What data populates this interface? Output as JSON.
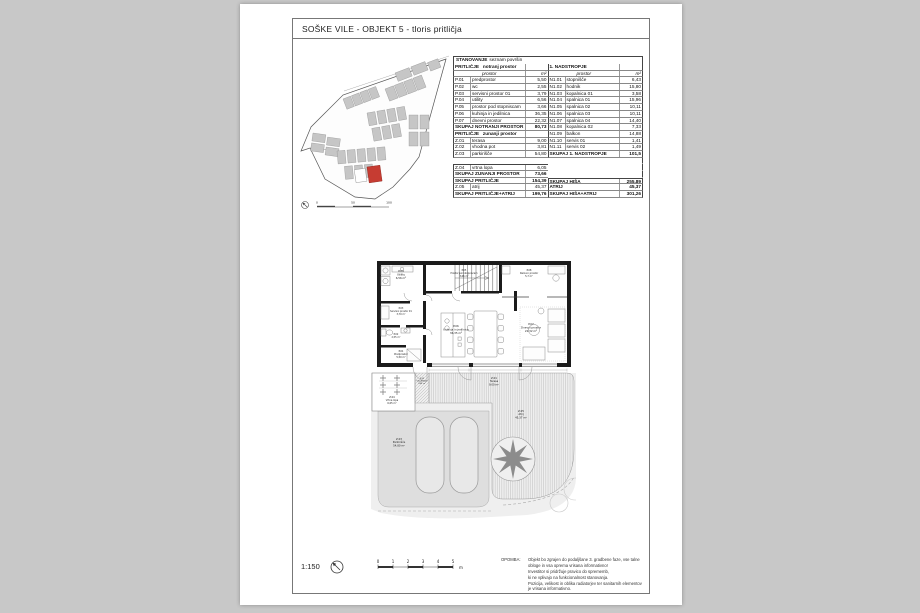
{
  "page": {
    "title": "SOŠKE VILE - OBJEKT 5 - tloris pritličja"
  },
  "table": {
    "title_main": "STANOVANJE",
    "title_sub": "seznam površin",
    "rows": [
      {
        "l": {
          "t": "sub",
          "n": "PRITLIČJE",
          "n2": "notranj prostor"
        },
        "r": {
          "t": "sub",
          "n": "1. NADSTROPJE"
        }
      },
      {
        "l": {
          "t": "col",
          "n": "prostor",
          "v": "m²"
        },
        "r": {
          "t": "col",
          "n": "prostor",
          "v": "m²"
        }
      },
      {
        "l": {
          "t": "data",
          "c": "P.01",
          "n": "predprostor",
          "v": "5,50"
        },
        "r": {
          "t": "data",
          "c": "N1.01",
          "n": "stopnišče",
          "v": "6,43"
        }
      },
      {
        "l": {
          "t": "data",
          "c": "P.02",
          "n": "wc",
          "v": "2,55"
        },
        "r": {
          "t": "data",
          "c": "N1.02",
          "n": "hodnik",
          "v": "15,80"
        }
      },
      {
        "l": {
          "t": "data",
          "c": "P.03",
          "n": "servisni prostor 01",
          "v": "3,79"
        },
        "r": {
          "t": "data",
          "c": "N1.03",
          "n": "kopalnica 01",
          "v": "3,58"
        }
      },
      {
        "l": {
          "t": "data",
          "c": "P.04",
          "n": "utility",
          "v": "6,56"
        },
        "r": {
          "t": "data",
          "c": "N1.04",
          "n": "spalnica 01",
          "v": "15,96"
        }
      },
      {
        "l": {
          "t": "data",
          "c": "P.05",
          "n": "prostor pod stopniscam",
          "v": "3,66"
        },
        "r": {
          "t": "data",
          "c": "N1.05",
          "n": "spalnica 02",
          "v": "10,11"
        }
      },
      {
        "l": {
          "t": "data",
          "c": "P.06",
          "n": "kuhinja in jedilnica",
          "v": "36,35"
        },
        "r": {
          "t": "data",
          "c": "N1.06",
          "n": "spalnica 03",
          "v": "10,11"
        }
      },
      {
        "l": {
          "t": "data",
          "c": "P.07",
          "n": "dnevni prostor",
          "v": "22,32"
        },
        "r": {
          "t": "data",
          "c": "N1.07",
          "n": "spalnica 04",
          "v": "14,40"
        }
      },
      {
        "l": {
          "t": "total",
          "n": "SKUPAJ NOTRANJI PROSTOR",
          "v": "80,73"
        },
        "r": {
          "t": "data",
          "c": "N1.08",
          "n": "kopalnica 02",
          "v": "7,33"
        }
      },
      {
        "l": {
          "t": "sub",
          "n": "PRITLIČJE",
          "n2": "zunanji prostor"
        },
        "r": {
          "t": "data",
          "c": "N1.09",
          "n": "balkon",
          "v": "14,88"
        }
      },
      {
        "l": {
          "t": "data",
          "c": "Z.01",
          "n": "terasa",
          "v": "9,00"
        },
        "r": {
          "t": "data",
          "c": "N1.10",
          "n": "servis 01",
          "v": "1,41"
        }
      },
      {
        "l": {
          "t": "data",
          "c": "Z.02",
          "n": "vhodna pot",
          "v": "3,81"
        },
        "r": {
          "t": "data",
          "c": "N1.11",
          "n": "servis 02",
          "v": "1,49"
        }
      },
      {
        "l": {
          "t": "data",
          "c": "Z.03",
          "n": "parkirišče",
          "v": "54,80"
        },
        "r": {
          "t": "total",
          "n": "SKUPAJ 1. NADSTROPJE",
          "v": "101,5"
        }
      },
      {
        "l": {
          "t": "blank"
        },
        "r": {
          "t": "blank"
        }
      },
      {
        "l": {
          "t": "data",
          "c": "Z.04",
          "n": "vrtna lopa",
          "v": "6,05",
          "bt": true
        },
        "r": {
          "t": "blank"
        }
      },
      {
        "l": {
          "t": "total",
          "n": "SKUPAJ ZUNANJI PROSTOR",
          "v": "73,66"
        },
        "r": {
          "t": "blank"
        }
      },
      {
        "l": {
          "t": "total",
          "n": "SKUPAJ PRITLIČJE",
          "v": "154,39"
        },
        "r": {
          "t": "total",
          "n": "SKUPAJ HIŠA",
          "v": "255,89",
          "bt": true
        }
      },
      {
        "l": {
          "t": "data",
          "c": "Z.05",
          "n": "atrij",
          "v": "45,37"
        },
        "r": {
          "t": "total",
          "n": "ATRIJ",
          "v": "45,37"
        }
      },
      {
        "l": {
          "t": "total",
          "n": "SKUPAJ PRITLIČJE+ATRIJ",
          "v": "199,76"
        },
        "r": {
          "t": "total",
          "n": "SKUPAJ HIŠA+ATRIJ",
          "v": "301,26"
        }
      }
    ]
  },
  "plan": {
    "rooms": {
      "p01": {
        "code": "P.01",
        "name": "Predprostor",
        "area": "5,50 m²"
      },
      "p02": {
        "code": "P.02",
        "name": "WC",
        "area": "2,55 m²"
      },
      "p03": {
        "code": "P.03",
        "name": "Servisni prostor 01",
        "area": "3,79 m²"
      },
      "p04": {
        "code": "P.04",
        "name": "Utility",
        "area": "6,56 m²"
      },
      "p05": {
        "code": "P.05",
        "name": "Prostor pod stopniscam",
        "area": "3,66 m²"
      },
      "p06": {
        "code": "P.06",
        "name": "Kuhinja in jedilnica",
        "area": "36,35 m²"
      },
      "p07": {
        "code": "P.07",
        "name": "Dnevni prostor",
        "area": "22,32 m²"
      },
      "p08": {
        "code": "P.08",
        "name": "Delovni prostor",
        "area": "5,7 m²"
      },
      "z01": {
        "code": "Z.01",
        "name": "Terasa",
        "area": "9,00 m²"
      },
      "z02": {
        "code": "Z.02",
        "name": "Vhodna pot",
        "area": "3,81 m²"
      },
      "z03": {
        "code": "Z.03",
        "name": "Parkirišče",
        "area": "54,80 m²"
      },
      "z04": {
        "code": "Z.04",
        "name": "Vrtna lopa",
        "area": "6,05 m²"
      },
      "z05": {
        "code": "Z.05",
        "name": "Atrij",
        "area": "45,37 m²"
      }
    }
  },
  "site_plan": {
    "scale_labels": [
      "0",
      "50",
      "100"
    ]
  },
  "footer": {
    "scale": "1:150",
    "scalebar": {
      "labels": [
        "0",
        "1",
        "2",
        "3",
        "4",
        "5"
      ],
      "unit": "m"
    },
    "note_label": "OPOMBA:",
    "note_lines": [
      "Objekt bo zgrajen do podaljšane 3. gradbene faze, vse talne",
      "obloge in vsa oprema vrisana informativno!",
      "Investitor si pridržuje pravico do sprememb,",
      "ki ne vplivajo na funkcionalnost stanovanja.",
      "Pozicija, velikost in oblika radiatorjev ter sanitarnih elementov",
      "je vrisana informativno."
    ]
  },
  "colors": {
    "highlight_red": "#c63c32",
    "building_gray": "#c6c6c6",
    "paper": "#ffffff",
    "background": "#c8c8c8"
  }
}
